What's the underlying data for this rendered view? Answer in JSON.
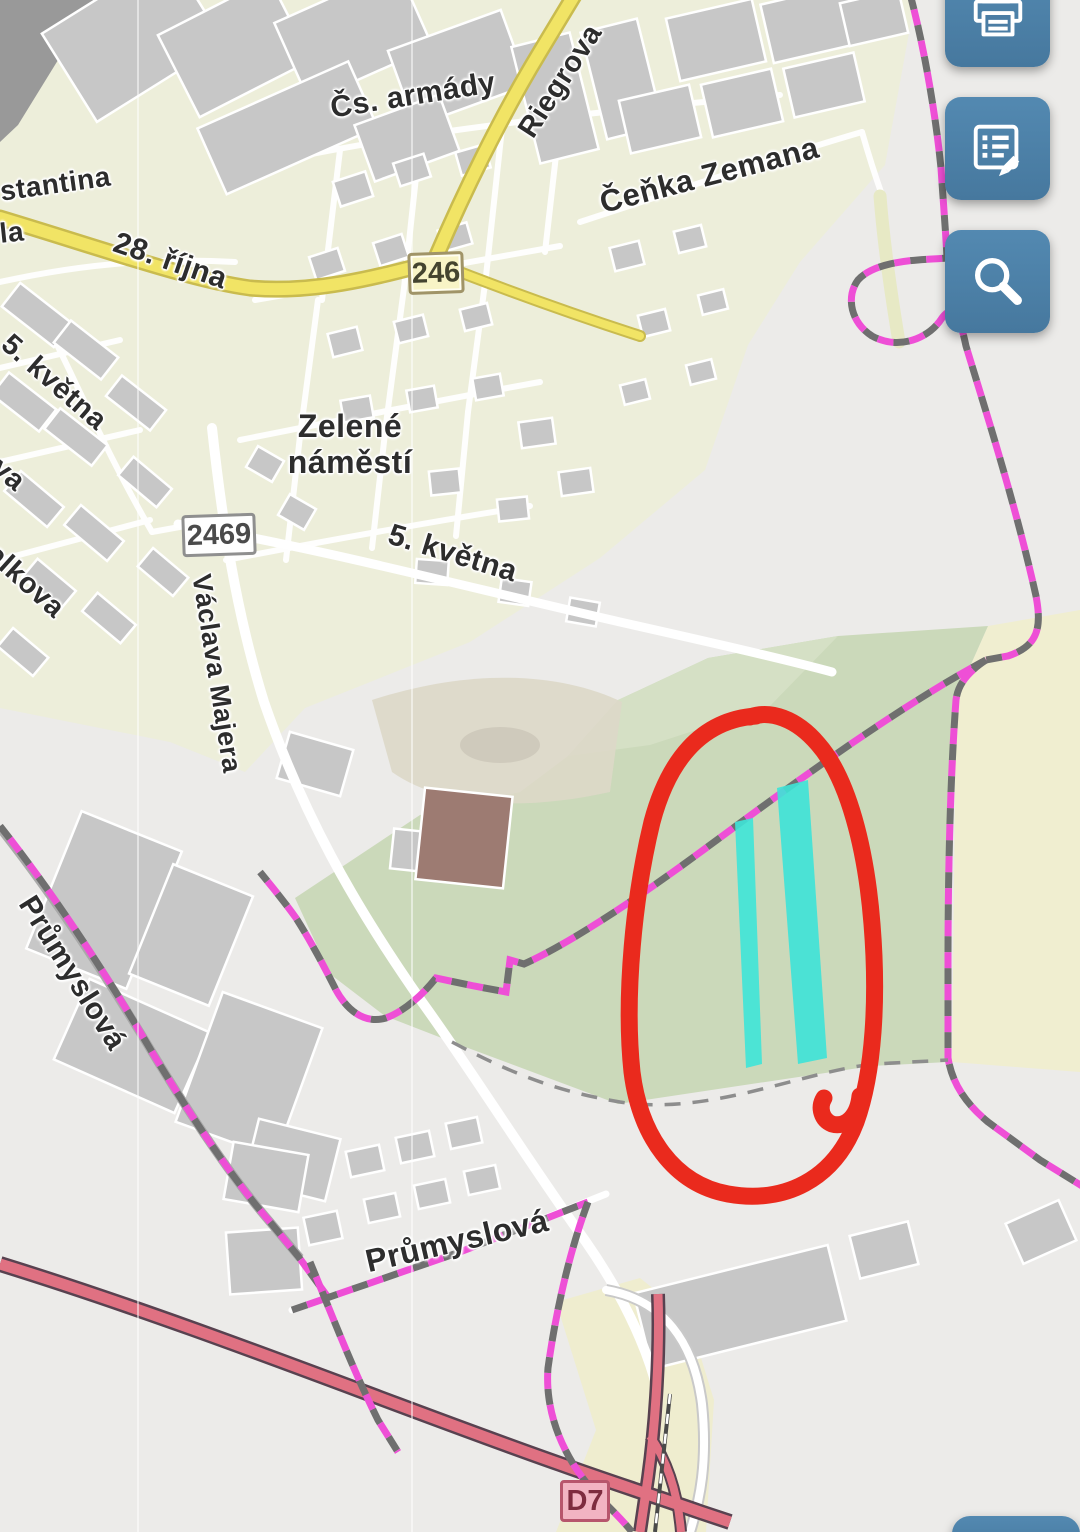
{
  "toolbar": {
    "button_color": "#4a7ba3",
    "buttons": [
      {
        "id": "print",
        "icon": "printer-icon"
      },
      {
        "id": "notes",
        "icon": "notes-edit-icon"
      },
      {
        "id": "search",
        "icon": "search-icon"
      },
      {
        "id": "bottom-partial",
        "icon": "none"
      }
    ]
  },
  "map": {
    "street_labels": {
      "konstantina_partial": "stantina",
      "la_partial": "la",
      "ulice_28_rijna": "28. října",
      "cs_armady": "Čs. armády",
      "riegrova": "Riegrova",
      "cenka_zemana": "Čeňka Zemana",
      "kvetna_5_west": "5. května",
      "ova_partial": "ova",
      "balkova_partial": "balkova",
      "zelene_namesti_line1": "Zelené",
      "zelene_namesti_line2": "náměstí",
      "kvetna_5_road": "5. května",
      "vaclava_majera": "Václava Majera",
      "prumyslova_west": "Průmyslová",
      "prumyslova_south": "Průmyslová"
    },
    "road_badges": {
      "r246": "246",
      "r2469": "2469",
      "d7": "D7"
    },
    "colors": {
      "boundary_pink": "#ee4fd6",
      "boundary_gray": "#6f6f6f",
      "road_yellow": "#f1e465",
      "motorway_red": "#e07182",
      "field_green": "#cbd9ba",
      "annotation_red": "#ea2a1d",
      "parcel_highlight_cyan": "#3ee4d8"
    },
    "annotation": {
      "shape": "hand-drawn-ellipse",
      "highlighted_parcels": 2
    }
  }
}
